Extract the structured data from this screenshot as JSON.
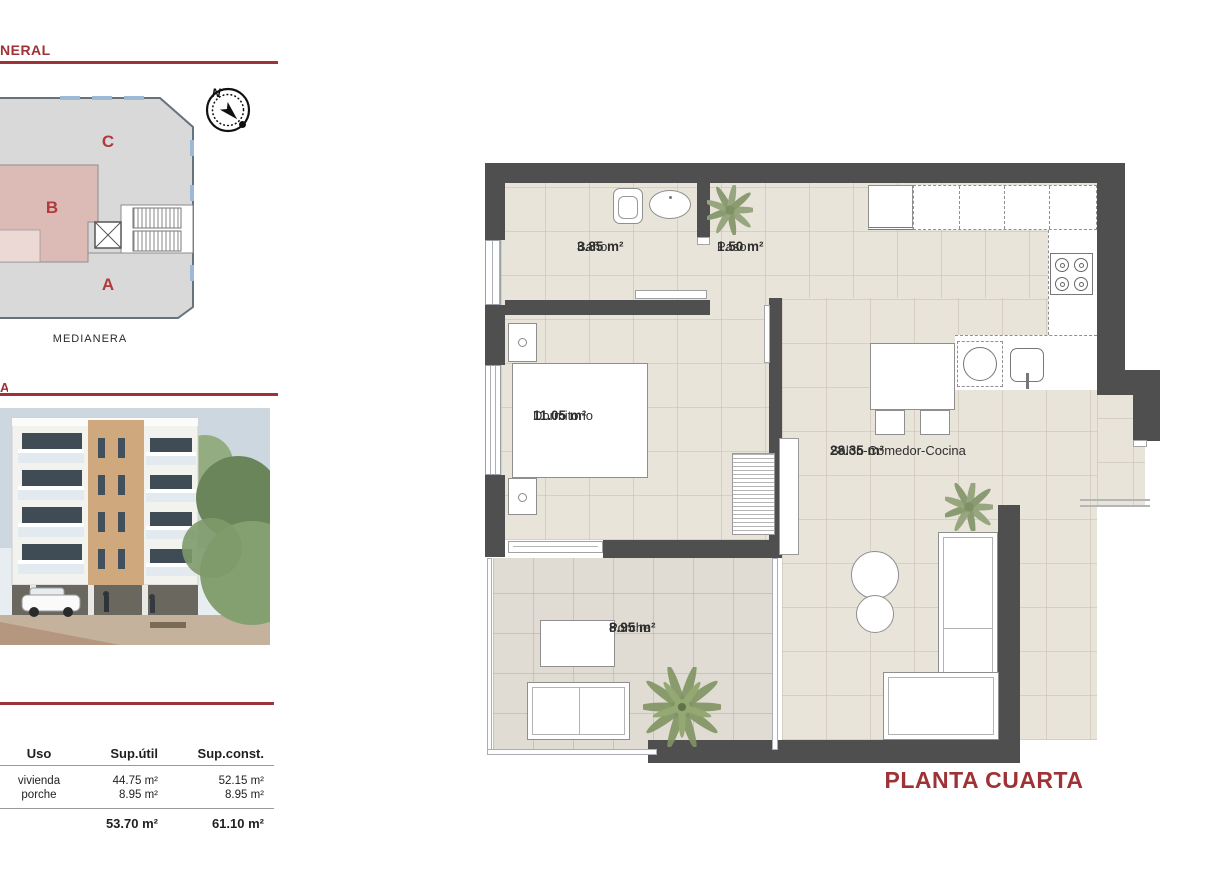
{
  "accent_color": "#9e3236",
  "header": {
    "title_fragment": "NERAL",
    "section2_fragment": "A"
  },
  "site_plan": {
    "unit_labels": [
      "C",
      "B",
      "A"
    ],
    "bottom_label": "MEDIANERA",
    "compass": {
      "north_label": "N"
    }
  },
  "areas_table": {
    "headers": [
      "Uso",
      "Sup.útil",
      "Sup.const."
    ],
    "rows": [
      {
        "uso": "vivienda",
        "sup_util": "44.75 m²",
        "sup_const": "52.15 m²"
      },
      {
        "uso": "porche",
        "sup_util": "8.95 m²",
        "sup_const": "8.95 m²"
      }
    ],
    "totals": {
      "sup_util": "53.70 m²",
      "sup_const": "61.10 m²"
    }
  },
  "floor_plan": {
    "title": "PLANTA CUARTA",
    "rooms": [
      {
        "name": "Baño",
        "area": "3.85 m²"
      },
      {
        "name": "Paso",
        "area": "1.50 m²"
      },
      {
        "name": "Dormitorio",
        "area": "11.05 m²"
      },
      {
        "name": "Salón-Comedor-Cocina",
        "area": "28.35 m²"
      },
      {
        "name": "Porche",
        "area": "8.95 m²"
      }
    ],
    "colors": {
      "wall": "#4f4f50",
      "floor": "#e9e4da",
      "porch_floor": "#e0dcd3"
    }
  }
}
